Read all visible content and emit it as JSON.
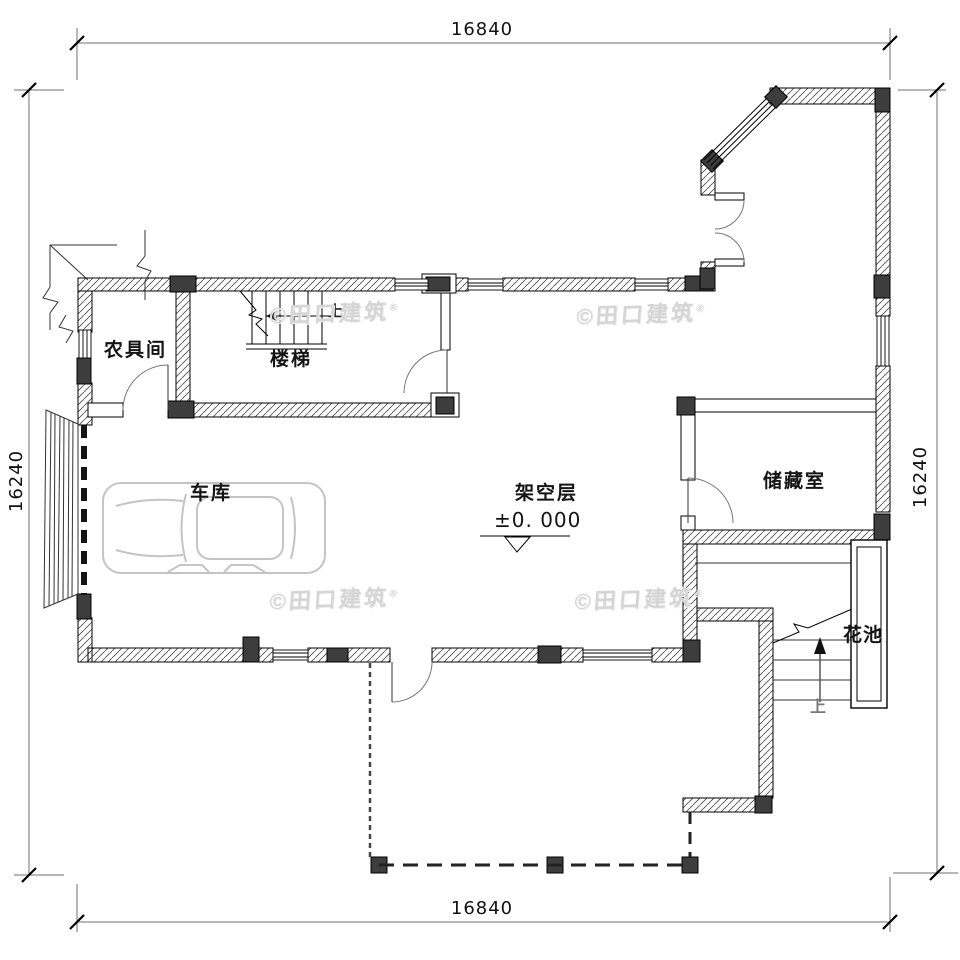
{
  "dimensions": {
    "top": "16840",
    "bottom": "16840",
    "left": "16240",
    "right": "16240"
  },
  "labels": {
    "farm_tool_room": "农具间",
    "stair_room": "楼梯",
    "garage": "车库",
    "open_floor": "架空层",
    "storage": "储藏室",
    "flower_bed": "花池"
  },
  "elevation": {
    "value": "±0. 000"
  },
  "direction": {
    "up_indoor": "上",
    "up_outdoor": "上"
  },
  "watermark": {
    "text": "©田口建筑",
    "registered": "®"
  },
  "colors": {
    "wall_fill_dark": "#3d3d3d",
    "line": "#000000",
    "watermark": "#d5d5d5",
    "car_outline": "#c4c4c4"
  }
}
